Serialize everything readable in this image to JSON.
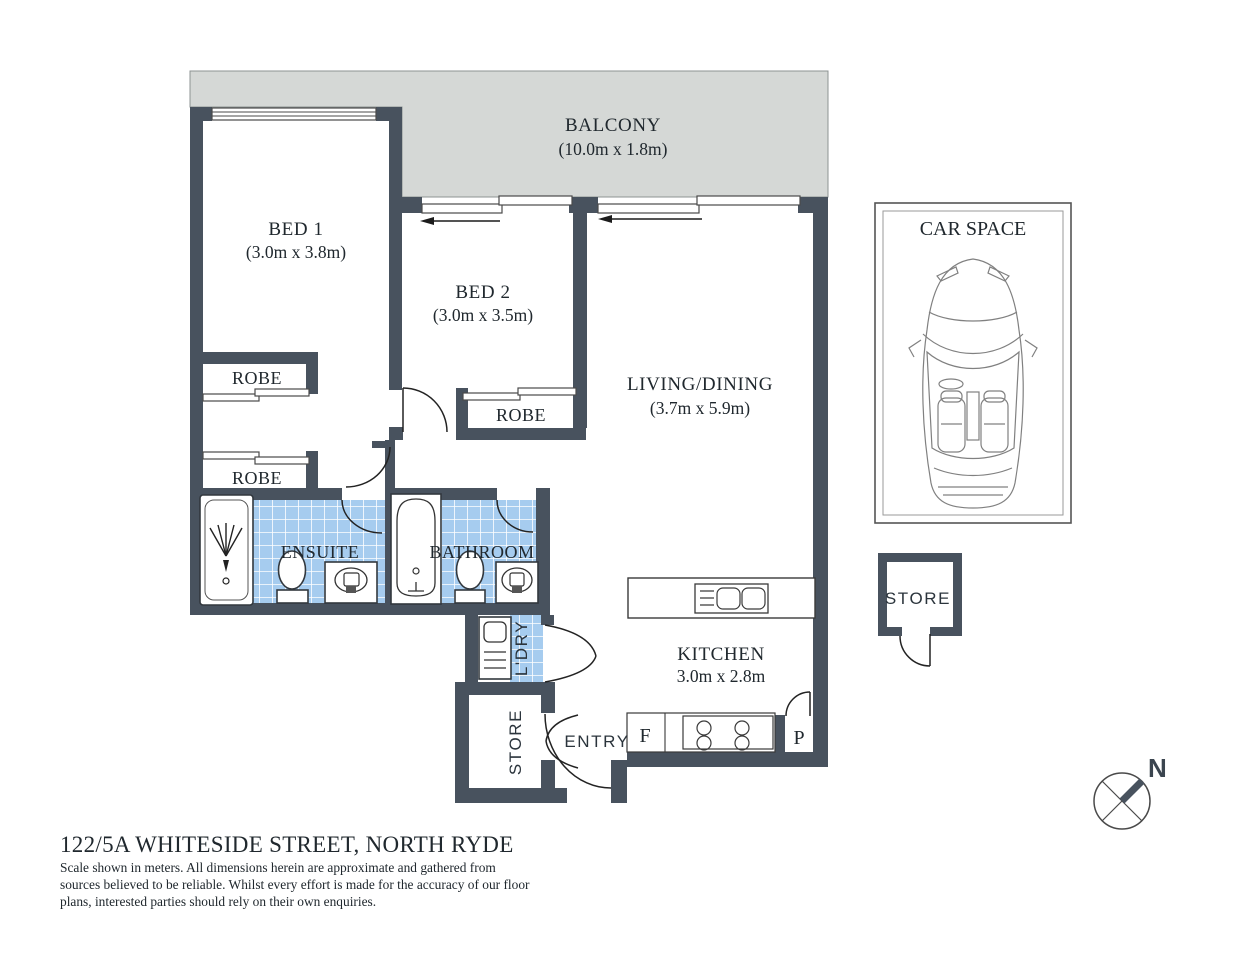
{
  "colors": {
    "wall": "#48525e",
    "balcony_fill": "#d5d8d6",
    "tile_fill": "#a6ccef",
    "text": "#20282e"
  },
  "rooms": {
    "balcony": {
      "label": "BALCONY",
      "dims": "(10.0m x 1.8m)"
    },
    "bed1": {
      "label": "BED 1",
      "dims": "(3.0m x 3.8m)"
    },
    "bed2": {
      "label": "BED 2",
      "dims": "(3.0m x 3.5m)"
    },
    "living": {
      "label": "LIVING/DINING",
      "dims": "(3.7m x 5.9m)"
    },
    "kitchen": {
      "label": "KITCHEN",
      "dims": "3.0m x 2.8m"
    },
    "ensuite": {
      "label": "ENSUITE"
    },
    "bathroom": {
      "label": "BATHROOM"
    },
    "robe_bed1_upper": {
      "label": "ROBE"
    },
    "robe_bed1_lower": {
      "label": "ROBE"
    },
    "robe_bed2": {
      "label": "ROBE"
    },
    "laundry": {
      "label": "L'DRY"
    },
    "store": {
      "label": "STORE"
    },
    "entry": {
      "label": "ENTRY"
    },
    "fridge": {
      "label": "F"
    },
    "pantry": {
      "label": "P"
    }
  },
  "annex": {
    "car_space_label": "CAR SPACE",
    "store_label": "STORE"
  },
  "compass": {
    "north_label": "N"
  },
  "footer": {
    "title": "122/5A WHITESIDE STREET, NORTH RYDE",
    "disclaimer_line1": "Scale shown in meters. All dimensions herein are approximate and gathered from",
    "disclaimer_line2": "sources believed to be  reliable. Whilst every effort is made for the accuracy of our floor",
    "disclaimer_line3": "plans, interested parties should rely on their own enquiries."
  }
}
